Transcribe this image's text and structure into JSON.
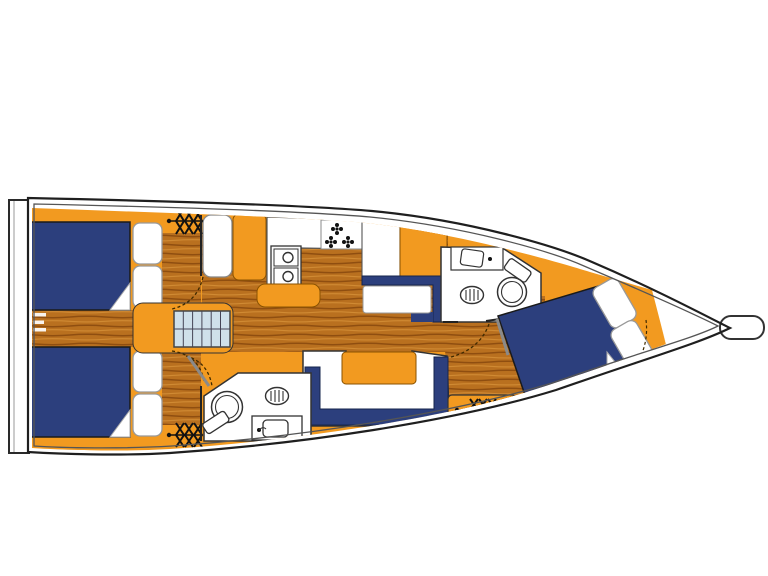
{
  "plan": {
    "name": "sailboat-interior-floor-plan",
    "features": [
      "swim-platform",
      "aft-cabin-starboard-berth",
      "aft-cabin-port-berth",
      "companionway-stairs",
      "galley-sink",
      "galley-stove",
      "galley-island",
      "salon-u-settee",
      "salon-table",
      "aft-head-toilet",
      "aft-head-sink",
      "forward-head-toilet",
      "forward-head-sink",
      "forward-cabin-v-berth",
      "deck-hatch-vent",
      "bow-anchor-fitting"
    ]
  },
  "colors": {
    "background": "#ffffff",
    "hull_fill": "#ffffff",
    "hull_outline": "#1f1f1f",
    "deck_line": "#555555",
    "interior_orange": "#F29A20",
    "cabinet_outline": "#8a5200",
    "upholstery_navy": "#2C3F7D",
    "navy_outline": "#16244d",
    "wood_base": "#B9701F",
    "wood_grain_dark": "#8F4E10",
    "wood_grain_light": "#D08A33",
    "steps_blue": "#CFE0EA",
    "fixture_white": "#FFFFFF",
    "fixture_stroke": "#333333",
    "pillow_stroke": "#999999",
    "door_arc": "#3f2a00",
    "door_leaf": "#8a8a8a",
    "symbol_black": "#111111"
  }
}
